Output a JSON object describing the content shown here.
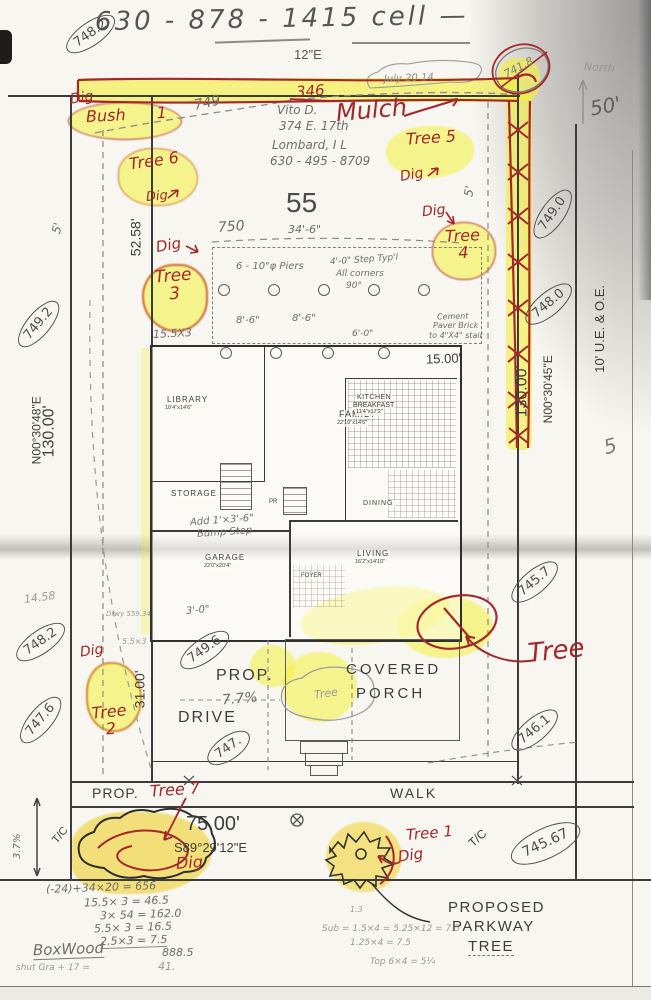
{
  "colors": {
    "red_ink": "#a3272b",
    "highlighter": "#f3f03a",
    "pencil": "#6d6d6d",
    "paper": "#f8f6f0"
  },
  "header": {
    "phone": "630 - 878 - 1415  cell —",
    "twelve_e": "12\"E",
    "date_note": "July 20 14",
    "north": "North",
    "fifty": "50'",
    "corner_elev": "741.8"
  },
  "owner": {
    "name": "Vito D.",
    "street": "374 E. 17th",
    "city": "Lombard, I L",
    "phone": "630 - 495 - 8709"
  },
  "lot": {
    "number": "55",
    "small_five": "5"
  },
  "red": {
    "dig": "Dig",
    "mulch": "Mulch",
    "n346": "346"
  },
  "trees": {
    "bush1": "Bush 1",
    "t6": "Tree 6",
    "t5": "Tree 5",
    "t4": "Tree 4",
    "t3": "Tree 3",
    "t2": "Tree 2",
    "t1": "Tree 1",
    "t7": "Tree 7",
    "big": "Tree",
    "porch_pencil": "Tree"
  },
  "elevations": {
    "tl": "748.2",
    "e749_0": "749.0",
    "e748_0": "748.0",
    "e749_2": "749.2",
    "e745_7": "745.7",
    "bl": "748.2",
    "e749_6": "749.6",
    "e747_6": "747.6",
    "e747": "747.",
    "e746_1": "746.1",
    "e745_67": "745.67"
  },
  "bearings": {
    "west": "N00°30'48\"E",
    "west_len": "130.00'",
    "east": "N00°30'45\"E",
    "east_len": "130.00'",
    "south": "S89°29'12\"E",
    "south_len": "75.00'",
    "easement": "10' U.E. & O.E."
  },
  "dims": {
    "d52_58": "52.58'",
    "d34_6": "34'-6\"",
    "d8_6a": "8'-6\"",
    "d8_6b": "8'-6\"",
    "d6_0": "6'-0\"",
    "d15_5x3": "15.5X3",
    "d15_00": "15.00'",
    "d31_00": "31.00'",
    "d3_0": "3'-0\"",
    "d5a": "5'",
    "d5b": "5'",
    "d14_58": "14.58",
    "d5_5x3": "5.5×3",
    "slope": "3.7%",
    "c749": "749",
    "c750": "750"
  },
  "notes": {
    "piers": "6 - 10\"φ Piers",
    "step_typ": "4'-0\" Step Typ'l",
    "corners": "All corners",
    "deg": "90°",
    "cem1": "Cement",
    "cem2": "Paver Brick",
    "cem3": "to 4\"X4\" stair",
    "bump1": "Add 1'×3'-6\"",
    "bump2": "Bump Step",
    "drwy": "Drwy 559.34"
  },
  "site": {
    "prop_drive": "PROP.",
    "grade": "7.7%",
    "drive": "DRIVE",
    "covered": "COVERED",
    "porch": "PORCH",
    "prop_walk": "PROP.",
    "walk": "WALK",
    "tc": "T/C",
    "proposed": "PROPOSED",
    "parkway": "PARKWAY",
    "tree": "TREE"
  },
  "rooms": {
    "library": "LIBRARY",
    "library_dim": "10'4\"x14'6\"",
    "family": "FAMILY",
    "family_dim": "22'10\"x14'6\"",
    "kitchen": "KITCHEN",
    "breakfast": "BREAKFAST",
    "kitchen_dim": "11'4\"x17'2\"",
    "storage": "STORAGE",
    "dining": "DINING",
    "pr": "PR",
    "garage": "GARAGE",
    "garage_dim": "22'0\"x20'4\"",
    "living": "LIVING",
    "living_dim": "16'2\"x14'10\"",
    "foyer": "FOYER"
  },
  "calcs": {
    "left": [
      "(-24)+34×20 =  656",
      "15.5× 3  =  46.5",
      "3× 54  =  162.0",
      "5.5× 3  =  16.5",
      "2.5×3  =  7.5",
      "888.5",
      "41."
    ],
    "boxwood": "BoxWood",
    "shrub": "shut Gra + 17  =",
    "right": [
      "Sub = 1.5×4 = 5.25×12 = 7.5",
      "1.25×4  =  7.5",
      "Top 6×4 = 5¼"
    ],
    "r_label": "1.3"
  }
}
